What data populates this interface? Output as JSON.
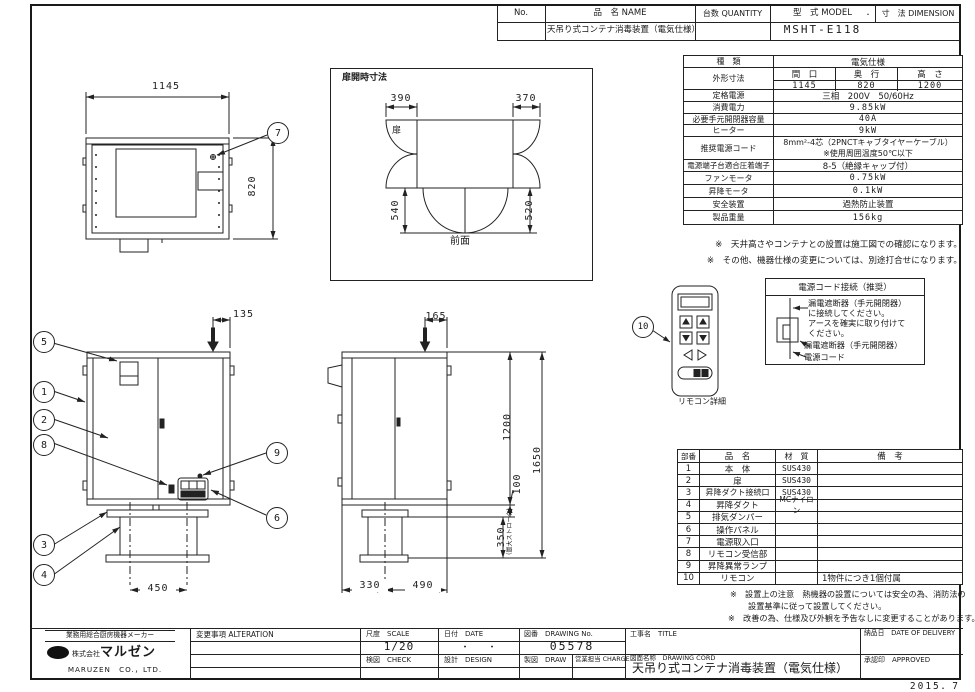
{
  "header": {
    "no_label": "No.",
    "name_label": "品　名 NAME",
    "qty_label": "台数 QUANTITY",
    "model_label": "型　式 MODEL",
    "dot": "．",
    "dim_label": "寸　法 DIMENSION",
    "name_value": "天吊り式コンテナ消毒装置（電気仕様）",
    "model_value": "MSHT-E118"
  },
  "spec": {
    "kind_label": "種　類",
    "kind_value": "電気仕様",
    "outline_label": "外形寸法",
    "w_label": "間　口",
    "d_label": "奥　行",
    "h_label": "高　さ",
    "w": "1145",
    "d": "820",
    "h": "1200",
    "rows": [
      {
        "label": "定格電源",
        "value": "三相　200V　50/60Hz"
      },
      {
        "label": "消費電力",
        "value": "9.85kW"
      },
      {
        "label": "必要手元開閉器容量",
        "value": "40A"
      },
      {
        "label": "ヒーター",
        "value": "9kW"
      },
      {
        "label": "推奨電源コード",
        "value": "8mm²-4芯（2PNCTキャブタイヤーケーブル）",
        "value2": "※使用周囲温度50℃以下"
      },
      {
        "label": "電源端子台適合圧着端子",
        "value": "8-5（絶縁キャップ付）"
      },
      {
        "label": "ファンモータ",
        "value": "0.75kW"
      },
      {
        "label": "昇降モータ",
        "value": "0.1kW"
      },
      {
        "label": "安全装置",
        "value": "過熱防止装置"
      },
      {
        "label": "製品重量",
        "value": "156kg"
      }
    ]
  },
  "notes_right": [
    "※　天井高さやコンテナとの設置は施工図での確認になります。",
    "※　その他、機器仕様の変更については、別途打合せになります。"
  ],
  "power": {
    "title": "電源コード接続（推奨）",
    "l1": "漏電遮断器（手元開閉器）",
    "l2": "に接続してください。",
    "l3": "アースを確実に取り付けて",
    "l4": "ください。",
    "l5": "漏電遮断器（手元開閉器）",
    "l6": "電源コード"
  },
  "parts": {
    "headers": {
      "no": "部番",
      "name": "品　名",
      "material": "材　質",
      "note": "備　考"
    },
    "rows": [
      {
        "no": "1",
        "name": "本　体",
        "material": "SUS430",
        "note": ""
      },
      {
        "no": "2",
        "name": "扉",
        "material": "SUS430",
        "note": ""
      },
      {
        "no": "3",
        "name": "昇降ダクト接続口",
        "material": "SUS430",
        "note": ""
      },
      {
        "no": "4",
        "name": "昇降ダクト",
        "material": "MCナイロン",
        "note": ""
      },
      {
        "no": "5",
        "name": "排気ダンパー",
        "material": "",
        "note": ""
      },
      {
        "no": "6",
        "name": "操作パネル",
        "material": "",
        "note": ""
      },
      {
        "no": "7",
        "name": "電源取入口",
        "material": "",
        "note": ""
      },
      {
        "no": "8",
        "name": "リモコン受信部",
        "material": "",
        "note": ""
      },
      {
        "no": "9",
        "name": "昇降異常ランプ",
        "material": "",
        "note": ""
      },
      {
        "no": "10",
        "name": "リモコン",
        "material": "",
        "note": "1物件につき1個付属"
      }
    ]
  },
  "notes_parts": {
    "l1a": "※　設置上の注意　熱機器の設置については安全の為、消防法の",
    "l1b": "設置基準に従って設置してください。",
    "l2": "※　改善の為、仕様及び外観を予告なしに変更することがあります。"
  },
  "dims": {
    "tv_w": "1145",
    "tv_d": "820",
    "door_caption": "扉開時寸法",
    "d_l": "390",
    "d_r": "370",
    "d_bl": "540",
    "d_br": "520",
    "door": "扉",
    "front": "前面",
    "f_off": "135",
    "f_duct": "450",
    "s_off": "165",
    "s_h1": "1200",
    "s_h2": "1650",
    "s_gap": "100",
    "s_stroke": "350",
    "s_note": "（最大ストローク）",
    "s_b1": "330",
    "s_b2": "490",
    "remote": "リモコン詳細"
  },
  "balloons": [
    "1",
    "2",
    "3",
    "4",
    "5",
    "6",
    "7",
    "8",
    "9",
    "10"
  ],
  "title_block": {
    "maker_tag": "業務用総合厨房機器メーカー",
    "company_prefix": "株式会社",
    "company_name": "マルゼン",
    "company_en": "MARUZEN　CO.，LTD.",
    "alteration": "変更事項 ALTERATION",
    "scale_label": "尺度　SCALE",
    "scale_value": "1/20",
    "date_label": "日付　DATE",
    "date_value": "・　　・",
    "no_label": "図番　DRAWING No.",
    "no_value": "05578",
    "title_label": "工事名　TITLE",
    "delivery_label": "納品日　DATE OF DELIVERY",
    "check_label": "検図　CHECK",
    "design_label": "設計　DESIGN",
    "draw_label": "製図　DRAW",
    "charge_label": "営業担当 CHARGE",
    "dwgname_label": "図面名称　DRAWING CORD",
    "dwgname_value": "天吊り式コンテナ消毒装置（電気仕様）",
    "approved_label": "承認印　APPROVED",
    "date_bottom": "2015．7"
  }
}
